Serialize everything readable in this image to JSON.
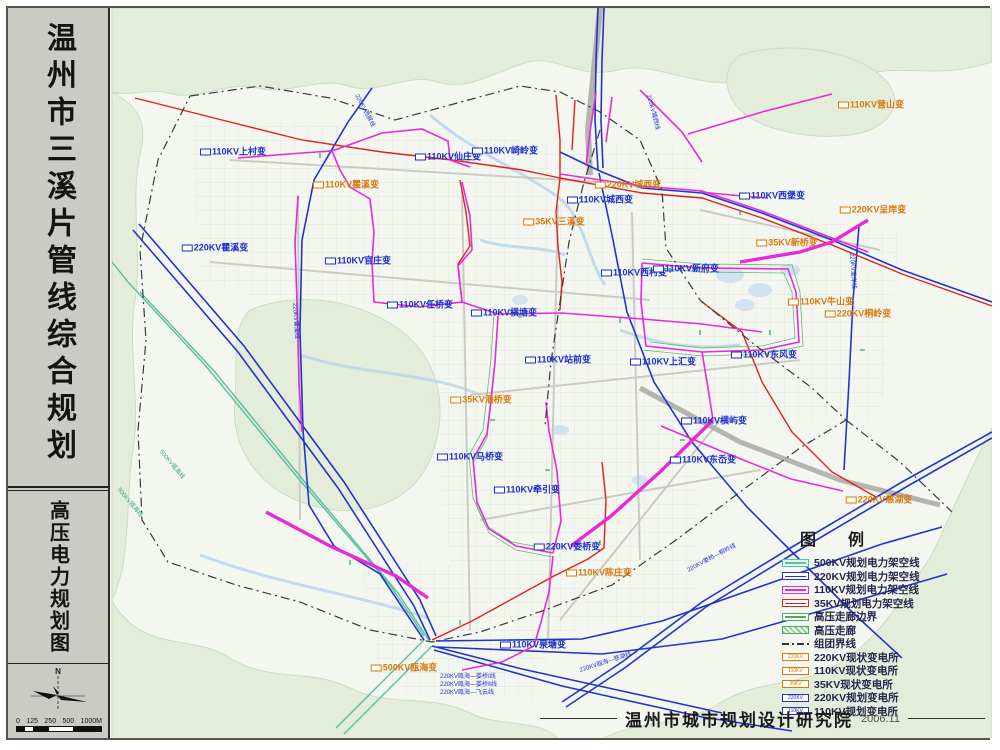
{
  "sidebar": {
    "title": "温州市三溪片管线综合规划",
    "subtitle": "高压电力规划图",
    "compass_label": "N",
    "scale_ticks": [
      "0",
      "125",
      "250",
      "500",
      "1000M"
    ]
  },
  "legend": {
    "title": "图 例",
    "items": [
      {
        "label": "500KV规划电力架空线",
        "kind": "line",
        "color": "#57c0a0",
        "fill": "#e2f5ee"
      },
      {
        "label": "220KV规划电力架空线",
        "kind": "line",
        "color": "#2334cc",
        "fill": "#ffffff"
      },
      {
        "label": "110KV规划电力架空线",
        "kind": "line",
        "color": "#e92ad8",
        "fill": "#ffffff"
      },
      {
        "label": "35KV规划电力架空线",
        "kind": "line",
        "color": "#e02121",
        "fill": "#ffffff"
      },
      {
        "label": "高压走廊边界",
        "kind": "line",
        "color": "#4aae62",
        "fill": "#ffffff"
      },
      {
        "label": "高压走廊",
        "kind": "corridor",
        "color": "#4aae62"
      },
      {
        "label": "组团界线",
        "kind": "dashdot",
        "color": "#333333"
      },
      {
        "label": "220KV现状变电所",
        "kind": "station",
        "color": "#d8790f",
        "text": "220KV"
      },
      {
        "label": "110KV现状变电所",
        "kind": "station",
        "color": "#d8790f",
        "text": "110KV"
      },
      {
        "label": "35KV现状变电所",
        "kind": "station",
        "color": "#d8790f",
        "text": "35KV"
      },
      {
        "label": "220KV规划变电所",
        "kind": "station",
        "color": "#2334cc",
        "text": "220KV"
      },
      {
        "label": "110KV规划变电所",
        "kind": "station",
        "color": "#2334cc",
        "text": "110KV"
      }
    ]
  },
  "footer": {
    "institute": "温州市城市规划设计研究院",
    "date": "2006.11"
  },
  "map": {
    "colors": {
      "planned": "#1b2fd0",
      "existing": "#d8790f",
      "kv500": "#57c0a0",
      "kv220": "#2334cc",
      "kv110": "#e92ad8",
      "kv35": "#e02121"
    },
    "labels": [
      {
        "text": "110KV上村变",
        "type": "planned",
        "x": 233,
        "y": 152
      },
      {
        "text": "220KV瞿溪变",
        "type": "planned",
        "x": 215,
        "y": 248
      },
      {
        "text": "110KV官庄变",
        "type": "planned",
        "x": 358,
        "y": 261
      },
      {
        "text": "110KV仙庄变",
        "type": "planned",
        "x": 448,
        "y": 157
      },
      {
        "text": "110KV崎岭变",
        "type": "planned",
        "x": 505,
        "y": 151
      },
      {
        "text": "110KV城西变",
        "type": "planned",
        "x": 600,
        "y": 200
      },
      {
        "text": "110KV西村变",
        "type": "planned",
        "x": 634,
        "y": 273
      },
      {
        "text": "110KV新府变",
        "type": "planned",
        "x": 686,
        "y": 269
      },
      {
        "text": "110KV西堡变",
        "type": "planned",
        "x": 772,
        "y": 196
      },
      {
        "text": "110KV任桥变",
        "type": "planned",
        "x": 420,
        "y": 305
      },
      {
        "text": "110KV横塘变",
        "type": "planned",
        "x": 504,
        "y": 313
      },
      {
        "text": "110KV站前变",
        "type": "planned",
        "x": 558,
        "y": 360
      },
      {
        "text": "110KV上汇变",
        "type": "planned",
        "x": 663,
        "y": 362
      },
      {
        "text": "110KV横屿变",
        "type": "planned",
        "x": 714,
        "y": 421
      },
      {
        "text": "110KV马桥变",
        "type": "planned",
        "x": 470,
        "y": 457
      },
      {
        "text": "110KV东风变",
        "type": "planned",
        "x": 764,
        "y": 355
      },
      {
        "text": "110KV牵引变",
        "type": "planned",
        "x": 527,
        "y": 490
      },
      {
        "text": "220KV娄桥变",
        "type": "planned",
        "x": 567,
        "y": 547
      },
      {
        "text": "110KV东岙变",
        "type": "planned",
        "x": 703,
        "y": 460
      },
      {
        "text": "110KV泉塘变",
        "type": "planned",
        "x": 533,
        "y": 645
      },
      {
        "text": "110KV瞿溪变",
        "type": "existing",
        "x": 346,
        "y": 185
      },
      {
        "text": "220KV城西变",
        "type": "existing",
        "x": 628,
        "y": 185
      },
      {
        "text": "35KV三溪变",
        "type": "existing",
        "x": 554,
        "y": 222
      },
      {
        "text": "110KV营山变",
        "type": "existing",
        "x": 871,
        "y": 105
      },
      {
        "text": "220KV呈岸变",
        "type": "existing",
        "x": 873,
        "y": 210
      },
      {
        "text": "35KV新桥变",
        "type": "existing",
        "x": 787,
        "y": 243
      },
      {
        "text": "110KV牛山变",
        "type": "existing",
        "x": 821,
        "y": 302
      },
      {
        "text": "220KV桐岭变",
        "type": "existing",
        "x": 858,
        "y": 314
      },
      {
        "text": "35KV潘桥变",
        "type": "existing",
        "x": 481,
        "y": 400
      },
      {
        "text": "110KV陈庄变",
        "type": "existing",
        "x": 599,
        "y": 573
      },
      {
        "text": "220KV慈湖变",
        "type": "existing",
        "x": 879,
        "y": 500
      },
      {
        "text": "500KV瓯海变",
        "type": "existing",
        "x": 404,
        "y": 668
      }
    ],
    "route_labels": [
      {
        "text": "220KV瓯海—娄桥Ⅰ线",
        "x": 440,
        "y": 674,
        "rot": 0,
        "cls": ""
      },
      {
        "text": "220KV瓯海—娄桥Ⅱ线",
        "x": 440,
        "y": 682,
        "rot": 0,
        "cls": ""
      },
      {
        "text": "220KV瓯海—飞云线",
        "x": 440,
        "y": 690,
        "rot": 0,
        "cls": ""
      },
      {
        "text": "220KV瞿溪线",
        "x": 294,
        "y": 300,
        "rot": 86,
        "cls": ""
      },
      {
        "text": "220KV西屏线",
        "x": 356,
        "y": 92,
        "rot": 62,
        "cls": ""
      },
      {
        "text": "220KV城西线",
        "x": 648,
        "y": 92,
        "rot": 75,
        "cls": ""
      },
      {
        "text": "220KV呈岸线",
        "x": 851,
        "y": 250,
        "rot": 86,
        "cls": ""
      },
      {
        "text": "220KV娄桥—桐岭线",
        "x": 688,
        "y": 568,
        "rot": -28,
        "cls": ""
      },
      {
        "text": "220KV瓯海—慈湖线",
        "x": 580,
        "y": 668,
        "rot": -18,
        "cls": ""
      },
      {
        "text": "500KV瓯海线",
        "x": 160,
        "y": 448,
        "rot": 50,
        "cls": "t500"
      },
      {
        "text": "500KV瓯海线",
        "x": 118,
        "y": 486,
        "rot": 50,
        "cls": "t500"
      }
    ]
  }
}
